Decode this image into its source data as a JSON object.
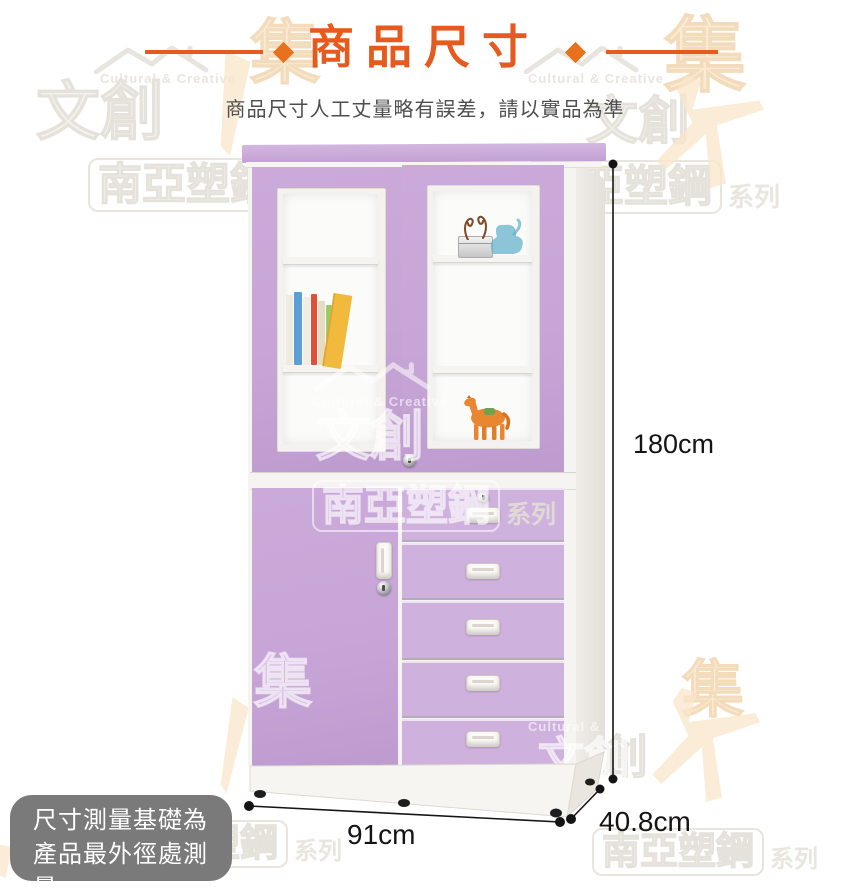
{
  "header": {
    "title": "商品尺寸",
    "subtitle": "商品尺寸人工丈量略有誤差，請以實品為準"
  },
  "dimensions": {
    "height": "180cm",
    "width": "91cm",
    "depth": "40.8cm"
  },
  "note": {
    "line1": "尺寸測量基礎為",
    "line2": "產品最外徑處測量"
  },
  "watermarks": {
    "english": "Cultural & Creative",
    "wenchuang": "文創",
    "brand": "南亞塑鋼",
    "series": "系列",
    "ji": "集"
  },
  "colors": {
    "accent_orange": "#E75A1D",
    "cabinet_purple": "#C7A6D7",
    "drawer_purple": "#CFB1DE",
    "note_gray": "#7A7A7A",
    "dimension_text": "#141414"
  }
}
